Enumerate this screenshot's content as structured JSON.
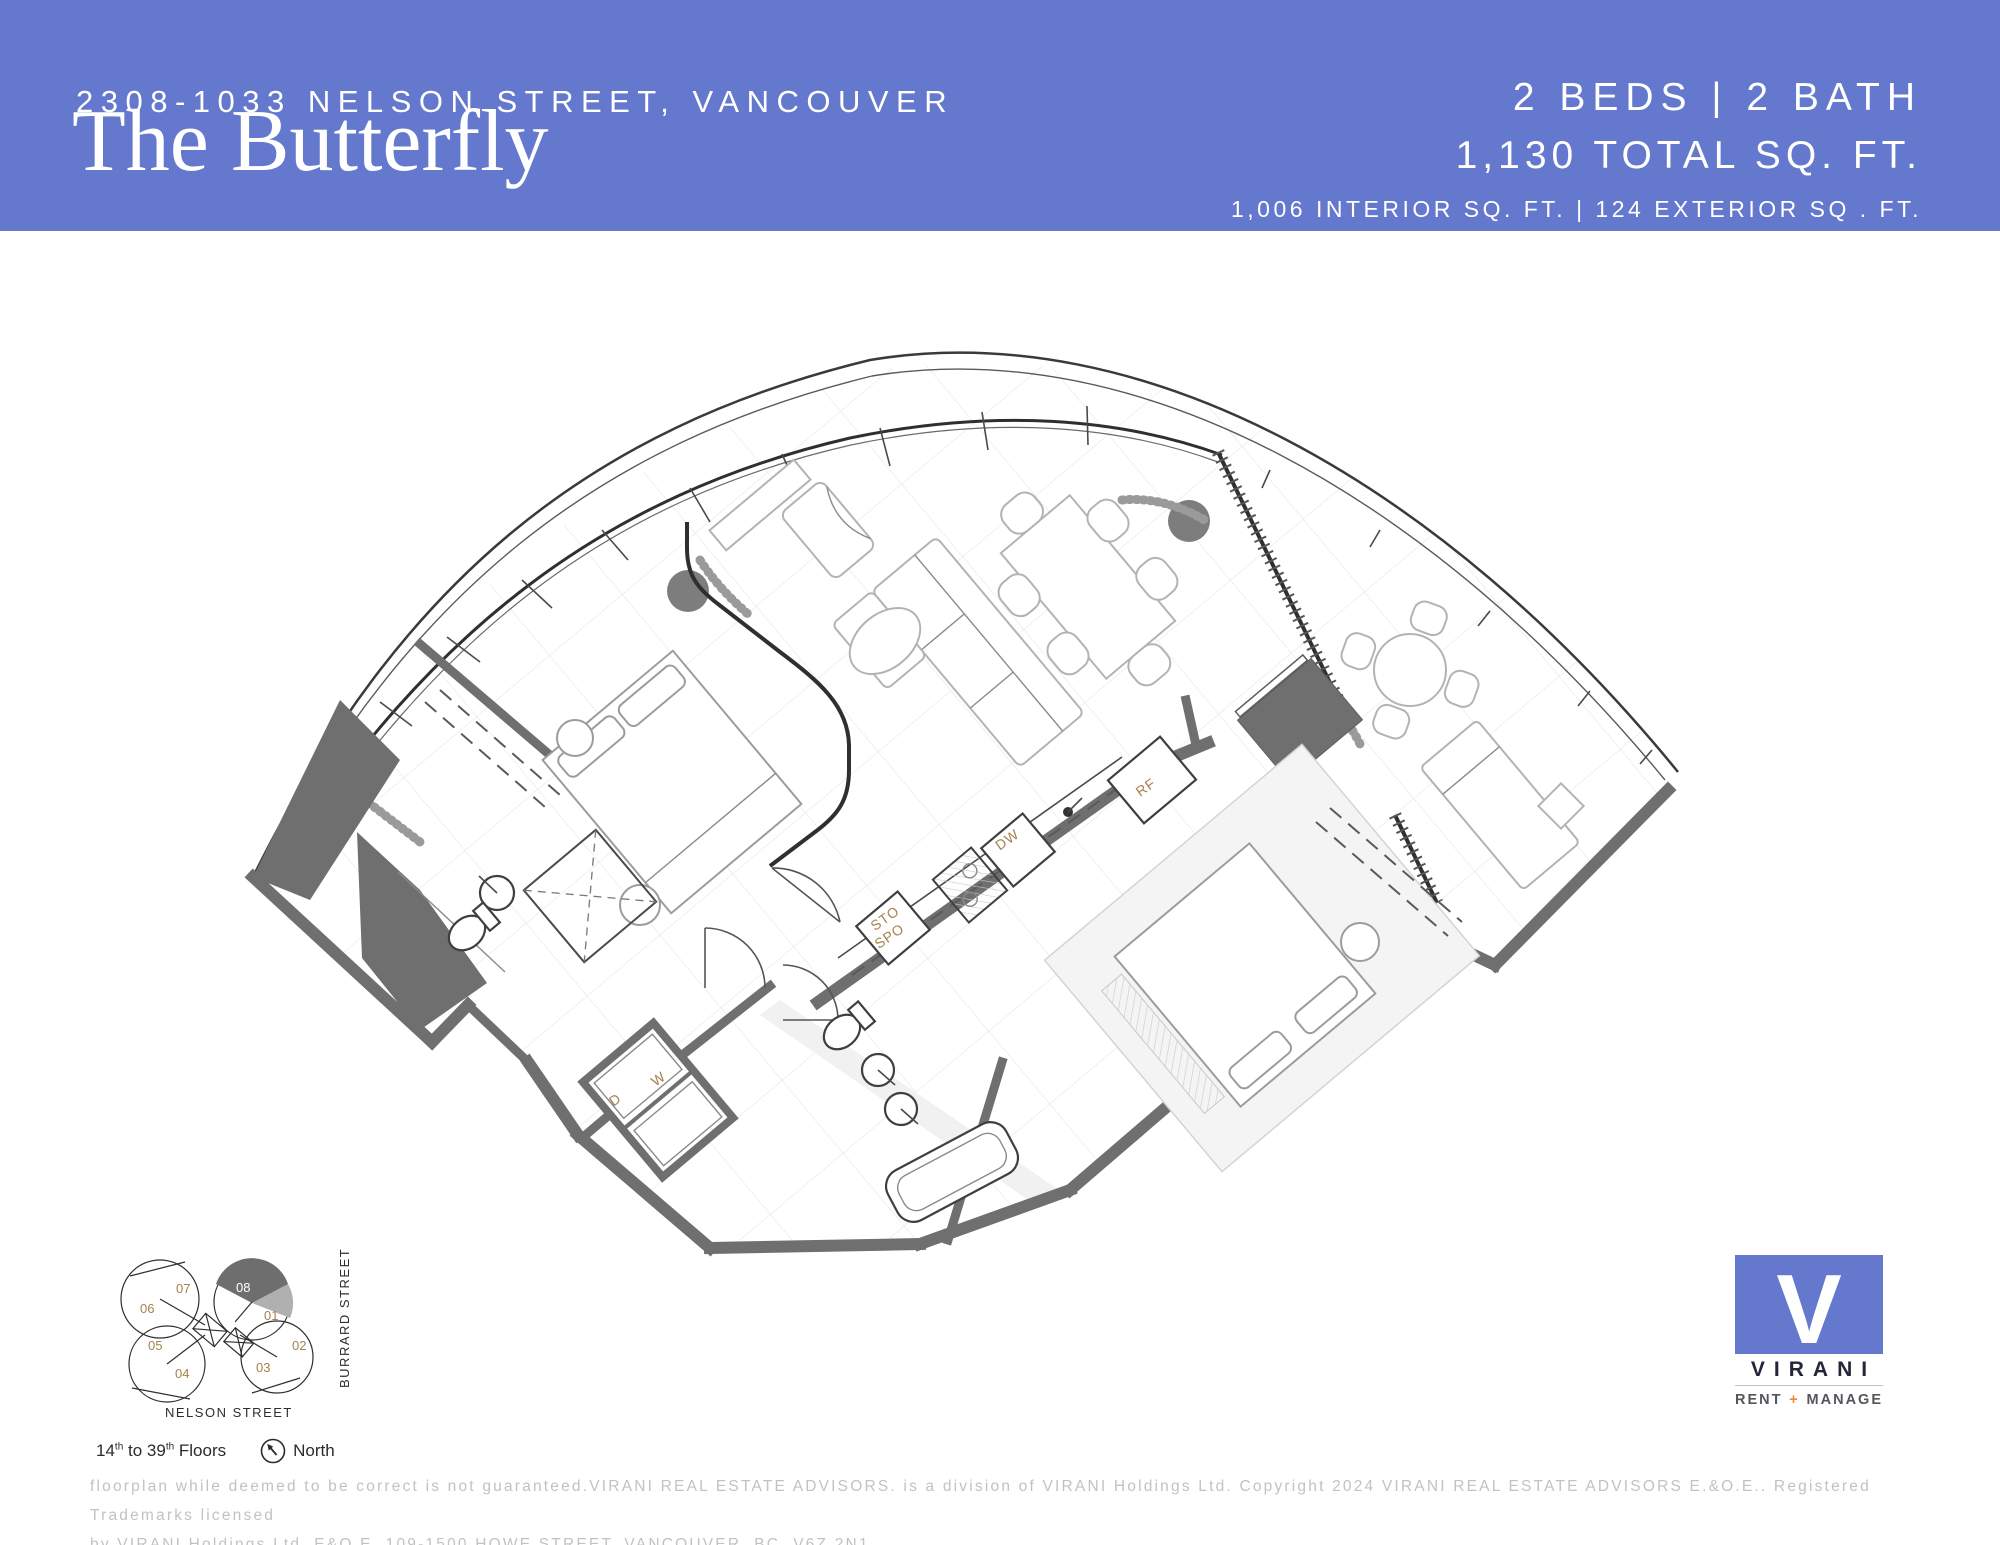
{
  "header": {
    "address": "2308-1033 NELSON STREET, VANCOUVER",
    "plan_name": "The Butterfly",
    "beds_baths": "2 BEDS | 2 BATH",
    "total_area": "1,130 TOTAL SQ. FT.",
    "area_breakdown": "1,006 INTERIOR SQ. FT. | 124 EXTERIOR SQ . FT.",
    "background_color": "#6478cd"
  },
  "floorplan": {
    "labels": {
      "refrigerator": "RF",
      "dishwasher": "DW",
      "storage_line1": "STO",
      "storage_line2": "SPO",
      "dryer": "D",
      "washer": "W"
    },
    "label_color": "#a5824f",
    "wall_color": "#6f6f6f"
  },
  "keyplan": {
    "units": [
      "01",
      "02",
      "03",
      "04",
      "05",
      "06",
      "07",
      "08"
    ],
    "highlighted_unit": "08",
    "street_right": "BURRARD STREET",
    "street_bottom": "NELSON STREET",
    "floors_note": {
      "a": "14",
      "sup_a": "th",
      "b": " to 39",
      "sup_b": "th",
      "c": " Floors"
    },
    "north_label": "North"
  },
  "logo": {
    "letter": "V",
    "name": "VIRANI",
    "tagline_rent": "RENT",
    "tagline_plus": "+",
    "tagline_manage": "MANAGE",
    "accent_color": "#6478cd",
    "plus_color": "#f0883a"
  },
  "disclaimer": {
    "line1": "floorplan while deemed to be correct is not guaranteed.VIRANI REAL ESTATE ADVISORS. is a division of VIRANI Holdings Ltd. Copyright 2024 VIRANI REAL ESTATE ADVISORS E.&O.E.. Registered Trademarks licensed",
    "line2": "by VIRANI Holdings Ltd. E&O.E. 109-1500 HOWE STREET, VANCOUVER, BC, V6Z 2N1"
  }
}
